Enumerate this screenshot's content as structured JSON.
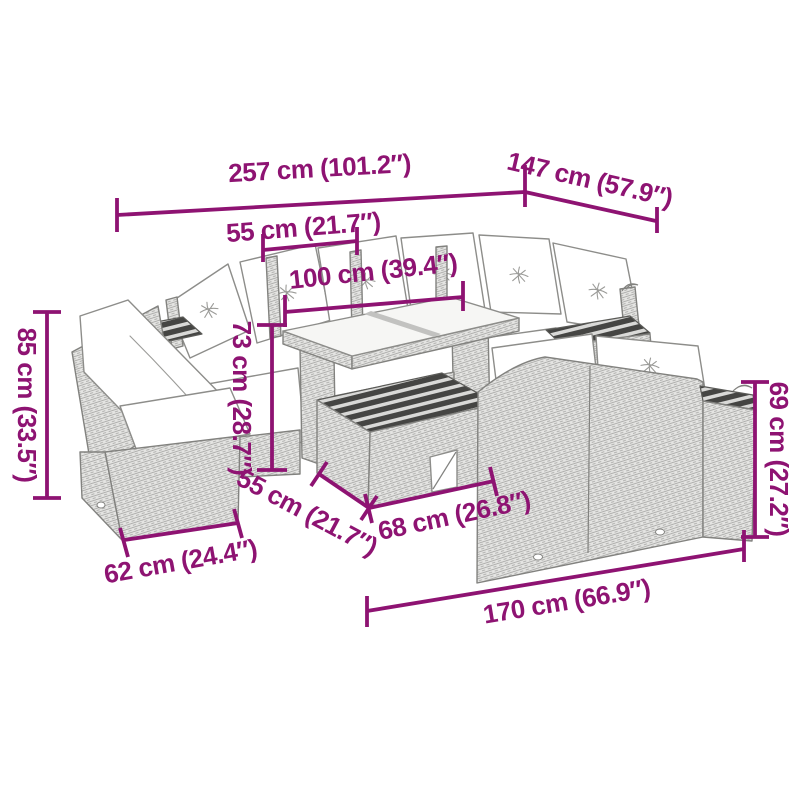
{
  "accent_color": "#8e1372",
  "artwork_description": "Monochrome line drawing of a poly rattan garden lounge set (armchair, corner sofa, glass-top table, slatted footstool and two-seater sofa with white cushions) annotated with magenta dimension lines",
  "dimensions": [
    {
      "id": "overall-width",
      "label": "257 cm (101.2″)"
    },
    {
      "id": "overall-depth",
      "label": "147 cm (57.9″)"
    },
    {
      "id": "seat-width",
      "label": "55 cm (21.7″)"
    },
    {
      "id": "table-length",
      "label": "100 cm (39.4″)"
    },
    {
      "id": "back-height",
      "label": "85 cm (33.5″)"
    },
    {
      "id": "table-height",
      "label": "73 cm (28.7″)"
    },
    {
      "id": "footstool-depth",
      "label": "55 cm (21.7″)"
    },
    {
      "id": "footstool-width",
      "label": "68 cm (26.8″)"
    },
    {
      "id": "chair-width",
      "label": "62 cm (24.4″)"
    },
    {
      "id": "sofa-back-height",
      "label": "69 cm (27.2″)"
    },
    {
      "id": "sofa-width",
      "label": "170 cm (66.9″)"
    }
  ]
}
